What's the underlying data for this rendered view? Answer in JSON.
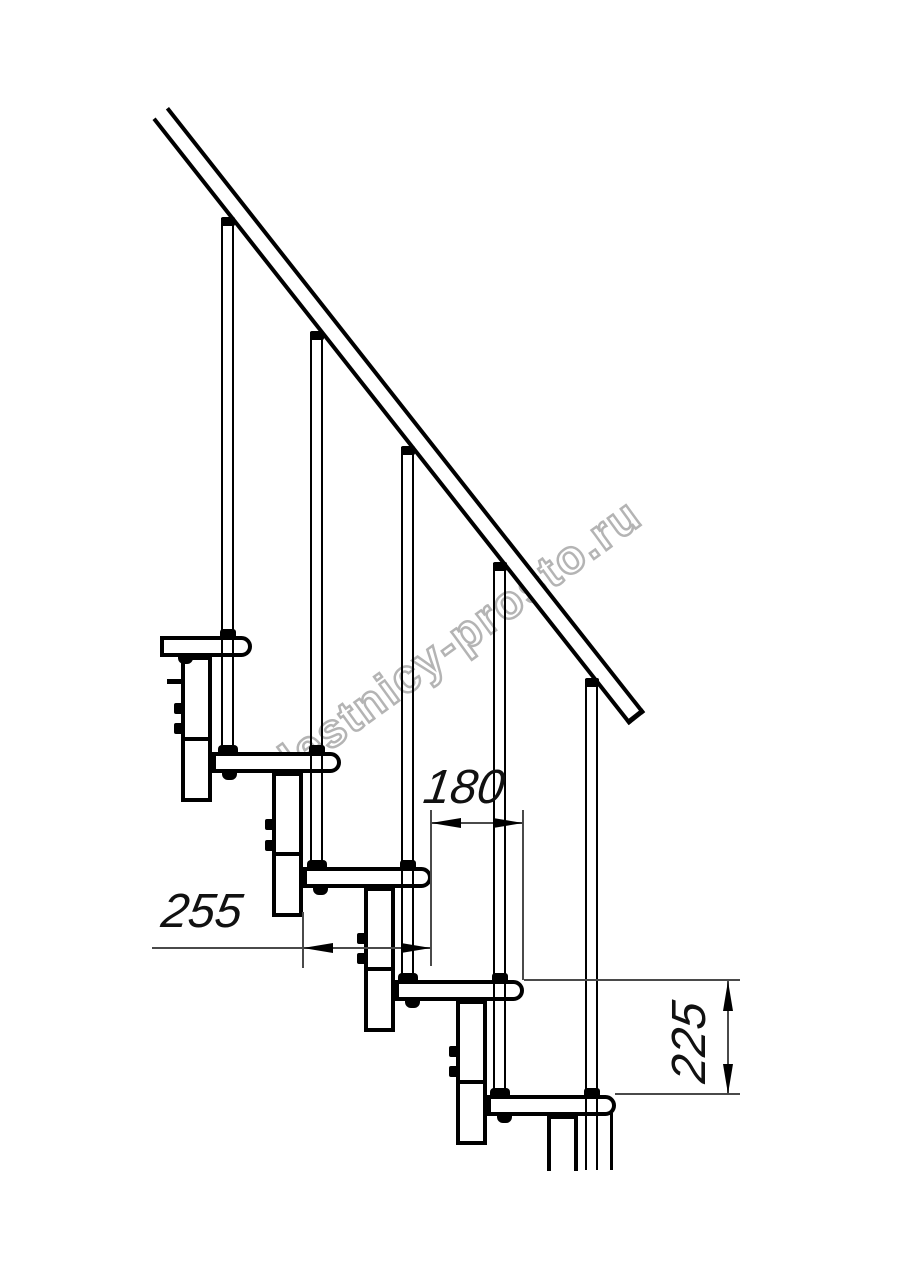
{
  "drawing": {
    "type": "modular staircase side view, technical drawing",
    "watermark": {
      "text": "lestnicy-prosto.ru",
      "outline_color": "#a8a8a8"
    },
    "dimensions": {
      "step_run": {
        "label": "180"
      },
      "tread_depth": {
        "label": "255"
      },
      "step_rise": {
        "label": "225"
      }
    },
    "colors": {
      "line": "#000000",
      "thin_line": "#4a4a4a",
      "background": "#ffffff"
    }
  }
}
